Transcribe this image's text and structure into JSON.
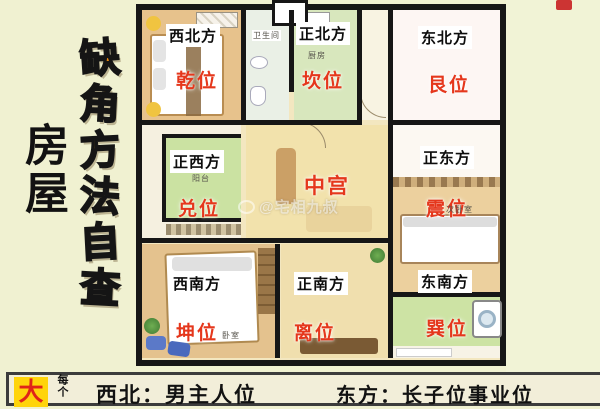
{
  "colors": {
    "page_bg": "#f0f1d1",
    "right_bg": "#f1f3d6",
    "wall": "#161616",
    "bagua_red": "#e5371c",
    "slogan_orange": [
      "#ee8c12",
      "#f09a10",
      "#f2a816",
      "#f2b214",
      "#ec7c10",
      "#e66a08"
    ],
    "badge_yellow": "#ffd40a",
    "badge_red": "#e02518"
  },
  "sidebar": {
    "title": "房屋",
    "slogan_chars": [
      "缺",
      "角",
      "方",
      "法",
      "自",
      "查"
    ]
  },
  "plan": {
    "rooms": {
      "nw": {
        "direction": "西北方",
        "bagua": "乾位"
      },
      "n": {
        "direction": "正北方",
        "bagua": "坎位",
        "room_label": "厨房"
      },
      "ne": {
        "direction": "东北方",
        "bagua": "艮位"
      },
      "w": {
        "direction": "正西方",
        "bagua": "兑位",
        "room_label": "阳台"
      },
      "center": {
        "bagua": "中宫"
      },
      "e": {
        "direction": "正东方",
        "bagua": "震位",
        "room_label": "次卧室"
      },
      "sw": {
        "direction": "西南方",
        "bagua": "坤位",
        "room_label": "卧室"
      },
      "s": {
        "direction": "正南方",
        "bagua": "离位"
      },
      "se": {
        "direction": "东南方",
        "bagua": "巽位"
      }
    },
    "small_labels": {
      "bathroom": "卫生间"
    },
    "watermark": "@宅相九叔"
  },
  "footer": {
    "badge": "大",
    "note": "每个",
    "left": "西北：男主人位",
    "right": "东方：长子位事业位"
  }
}
